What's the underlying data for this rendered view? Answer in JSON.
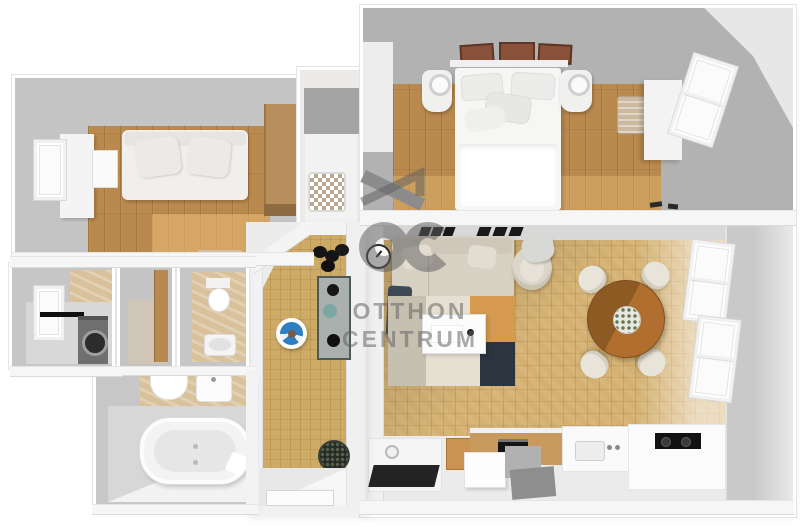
{
  "watermark": {
    "logo_letters": "oc",
    "brand_line1": "OTTHON",
    "brand_line2": "CENTRUM",
    "color": "#6a6a6a"
  },
  "palette": {
    "background": "#ffffff",
    "wall_top_white": "#f6f6f6",
    "wall_face_light": "#d9d9d9",
    "wall_face_gray": "#c6c6c6",
    "wall_face_dark": "#a9a9a9",
    "wood_floor": "#b9894d",
    "wood_floor_highlight": "#d8b26b",
    "parquet_floor": "#d4b172",
    "hallway_parquet": "#cdab66",
    "bathroom_tile_beige": "#d8c19b",
    "dining_table_wood": "#b06f2e",
    "sofa_beige": "#d7d1c3",
    "bed_white": "#f6f6f5",
    "rug_cream": "#e5e0d2",
    "rug_orange": "#d59a4f",
    "rug_navy": "#2b3540",
    "rug_gray": "#c6c0b1",
    "ottoman_blue": "#2f7fc4",
    "appliance_gray": "#6f6f6f",
    "kitchen_counter_wood": "#c99a5e",
    "decor_black": "#151515",
    "watermark_gray": "#6a6a6a"
  },
  "floorplan": {
    "view": "3d-top-down-render",
    "rooms": [
      {
        "id": "room-top-left",
        "furniture": [
          "sofa",
          "window",
          "white-wardrobe",
          "desk",
          "wood-wardrobe"
        ]
      },
      {
        "id": "bedroom",
        "furniture": [
          "double-bed",
          "nightstand-left",
          "nightstand-right",
          "wall-frames",
          "wardrobe",
          "laundry-basket",
          "window"
        ]
      },
      {
        "id": "pantry",
        "furniture": [
          "storage-basket"
        ]
      },
      {
        "id": "utility-room",
        "furniture": [
          "washing-machine",
          "window",
          "wall-rod"
        ]
      },
      {
        "id": "closet",
        "furniture": [
          "wooden-door"
        ]
      },
      {
        "id": "wc",
        "furniture": [
          "toilet",
          "hand-sink"
        ]
      },
      {
        "id": "bathroom",
        "furniture": [
          "bathtub",
          "corner-sink",
          "washbasin"
        ]
      },
      {
        "id": "hallway",
        "furniture": [
          "console-table",
          "blue-ottoman",
          "plant-pot",
          "wall-plant",
          "entry-door"
        ]
      },
      {
        "id": "living-dining-kitchen",
        "furniture": [
          "corner-sofa",
          "navy-throw",
          "armchair",
          "area-rug",
          "coffee-table",
          "dining-table",
          "dining-chairs",
          "wall-clock",
          "wall-shelf-decor",
          "windows",
          "kitchen-counter",
          "oven",
          "kitchen-sink",
          "cooktop",
          "tv-desk",
          "moving-boxes"
        ]
      }
    ]
  }
}
